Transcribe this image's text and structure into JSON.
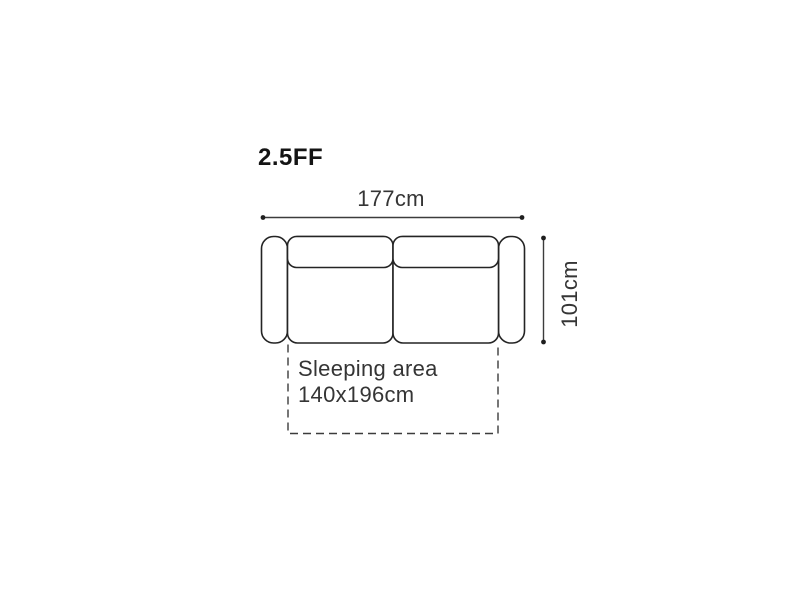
{
  "diagram": {
    "model_title": "2.5FF",
    "width_dimension_label": "177cm",
    "height_dimension_label": "101cm",
    "sleeping_area": {
      "label": "Sleeping area",
      "size": "140x196cm"
    },
    "colors": {
      "background": "#ffffff",
      "sofa_outline": "#242424",
      "dimension_line": "#3c3c3c",
      "dimension_dot": "#1f1f1f",
      "text": "#353535",
      "title": "#141414"
    }
  }
}
